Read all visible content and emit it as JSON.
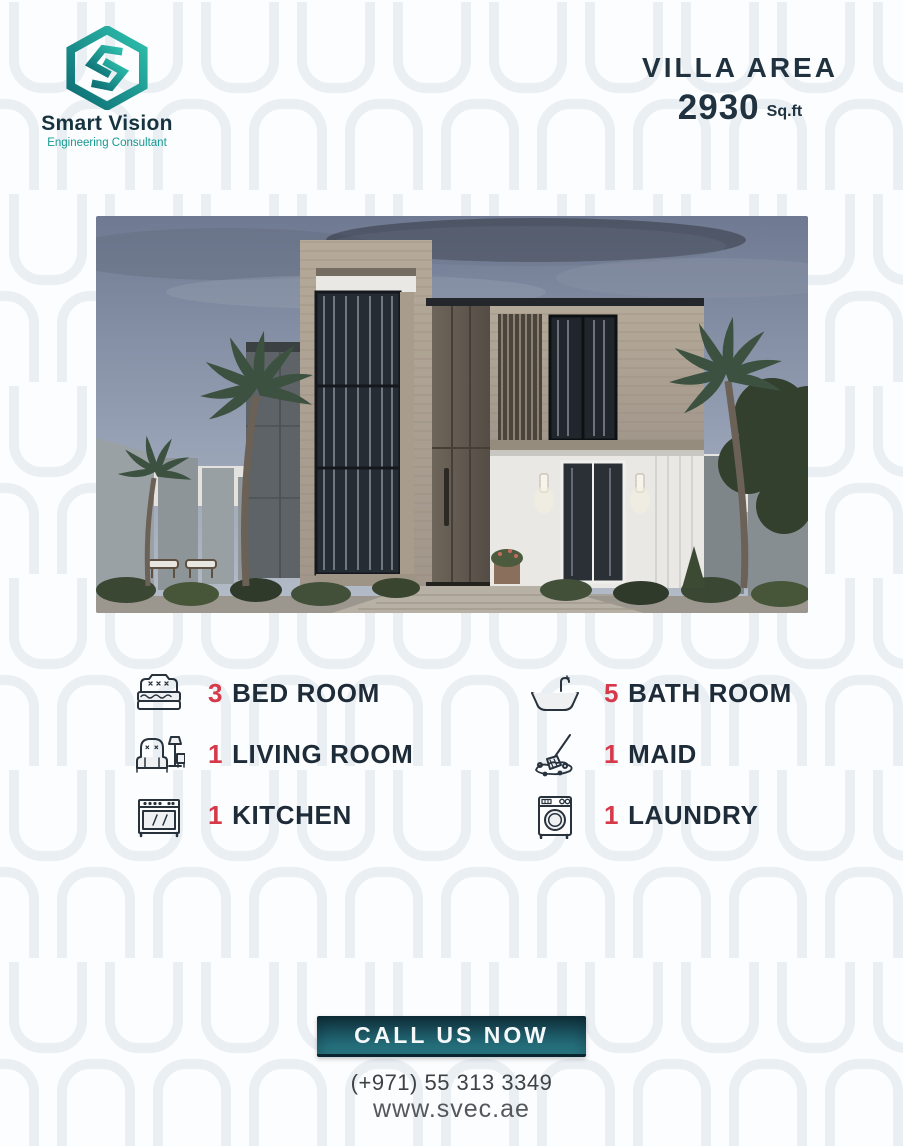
{
  "brand": {
    "name": "Smart Vision",
    "tagline": "Engineering Consultant",
    "logo_icon": "hexagon-s-logo",
    "colors": {
      "teal_dark": "#0d6b72",
      "teal_light": "#2ec1ae",
      "navy": "#16333f"
    }
  },
  "area": {
    "label": "VILLA AREA",
    "value": "2930",
    "unit": "Sq.ft"
  },
  "features": {
    "items": [
      {
        "icon": "bed-icon",
        "count": "3",
        "label": "BED ROOM"
      },
      {
        "icon": "bathtub-icon",
        "count": "5",
        "label": "BATH ROOM"
      },
      {
        "icon": "sofa-icon",
        "count": "1",
        "label": "LIVING ROOM"
      },
      {
        "icon": "mop-icon",
        "count": "1",
        "label": "MAID"
      },
      {
        "icon": "stove-icon",
        "count": "1",
        "label": "KITCHEN"
      },
      {
        "icon": "washing-machine-icon",
        "count": "1",
        "label": "LAUNDRY"
      }
    ]
  },
  "cta": {
    "label": "CALL US NOW"
  },
  "contact": {
    "phone": "(+971) 55 313 3349",
    "website": "www.svec.ae"
  },
  "colors": {
    "accent_red": "#d63a4a",
    "text_navy": "#1e2c39",
    "button_gradient_top": "#10303b",
    "button_gradient_bottom": "#2f8894"
  }
}
